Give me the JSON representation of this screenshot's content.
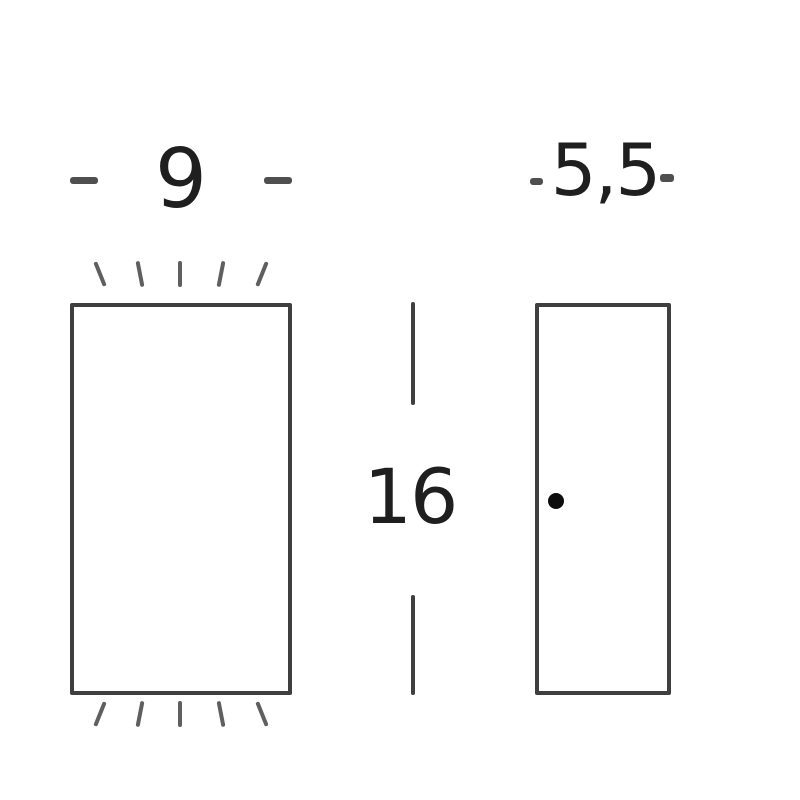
{
  "diagram_type": "product-dimension-drawing",
  "labels": {
    "front_width": "9",
    "height": "16",
    "side_depth": "5,5"
  },
  "icons": {
    "light-ray-tick": "short slanted line (up/down light beam mark)",
    "fixing-hole-dot": "small filled circle"
  },
  "colors": {
    "background": "#ffffff",
    "outline": "#3f3f3f",
    "tick": "#5f5f5f",
    "dash": "#4f4f4f",
    "text": "#1f1f1f",
    "dot": "#0d0d0d"
  }
}
